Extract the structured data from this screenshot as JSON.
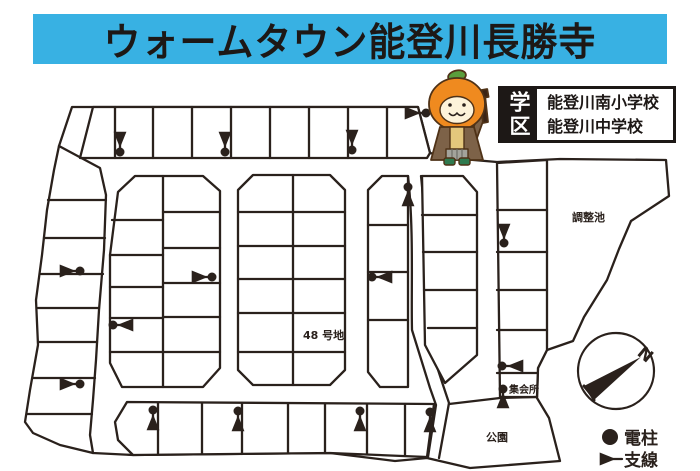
{
  "header": {
    "title": "ウォームタウン能登川長勝寺",
    "bg_color": "#38b1e3",
    "text_color": "#1d1816"
  },
  "school_district": {
    "label": "学区",
    "schools": [
      "能登川南小学校",
      "能登川中学校"
    ]
  },
  "map": {
    "labels": {
      "pond": "調整池",
      "lot48": "48 号地",
      "meeting_hall": "集会所",
      "park": "公園"
    },
    "compass_north": "N",
    "line_color": "#2a211c"
  },
  "legend": {
    "pole": "電柱",
    "wire": "支線"
  },
  "mascot": {
    "colors": {
      "head": "#ef8a1f",
      "leaf": "#5a9e3c",
      "face": "#fdf3da",
      "coat": "#7d6248",
      "shirt": "#e4c77c",
      "pants": "#a3a39b",
      "boots": "#2f7a4f"
    }
  }
}
